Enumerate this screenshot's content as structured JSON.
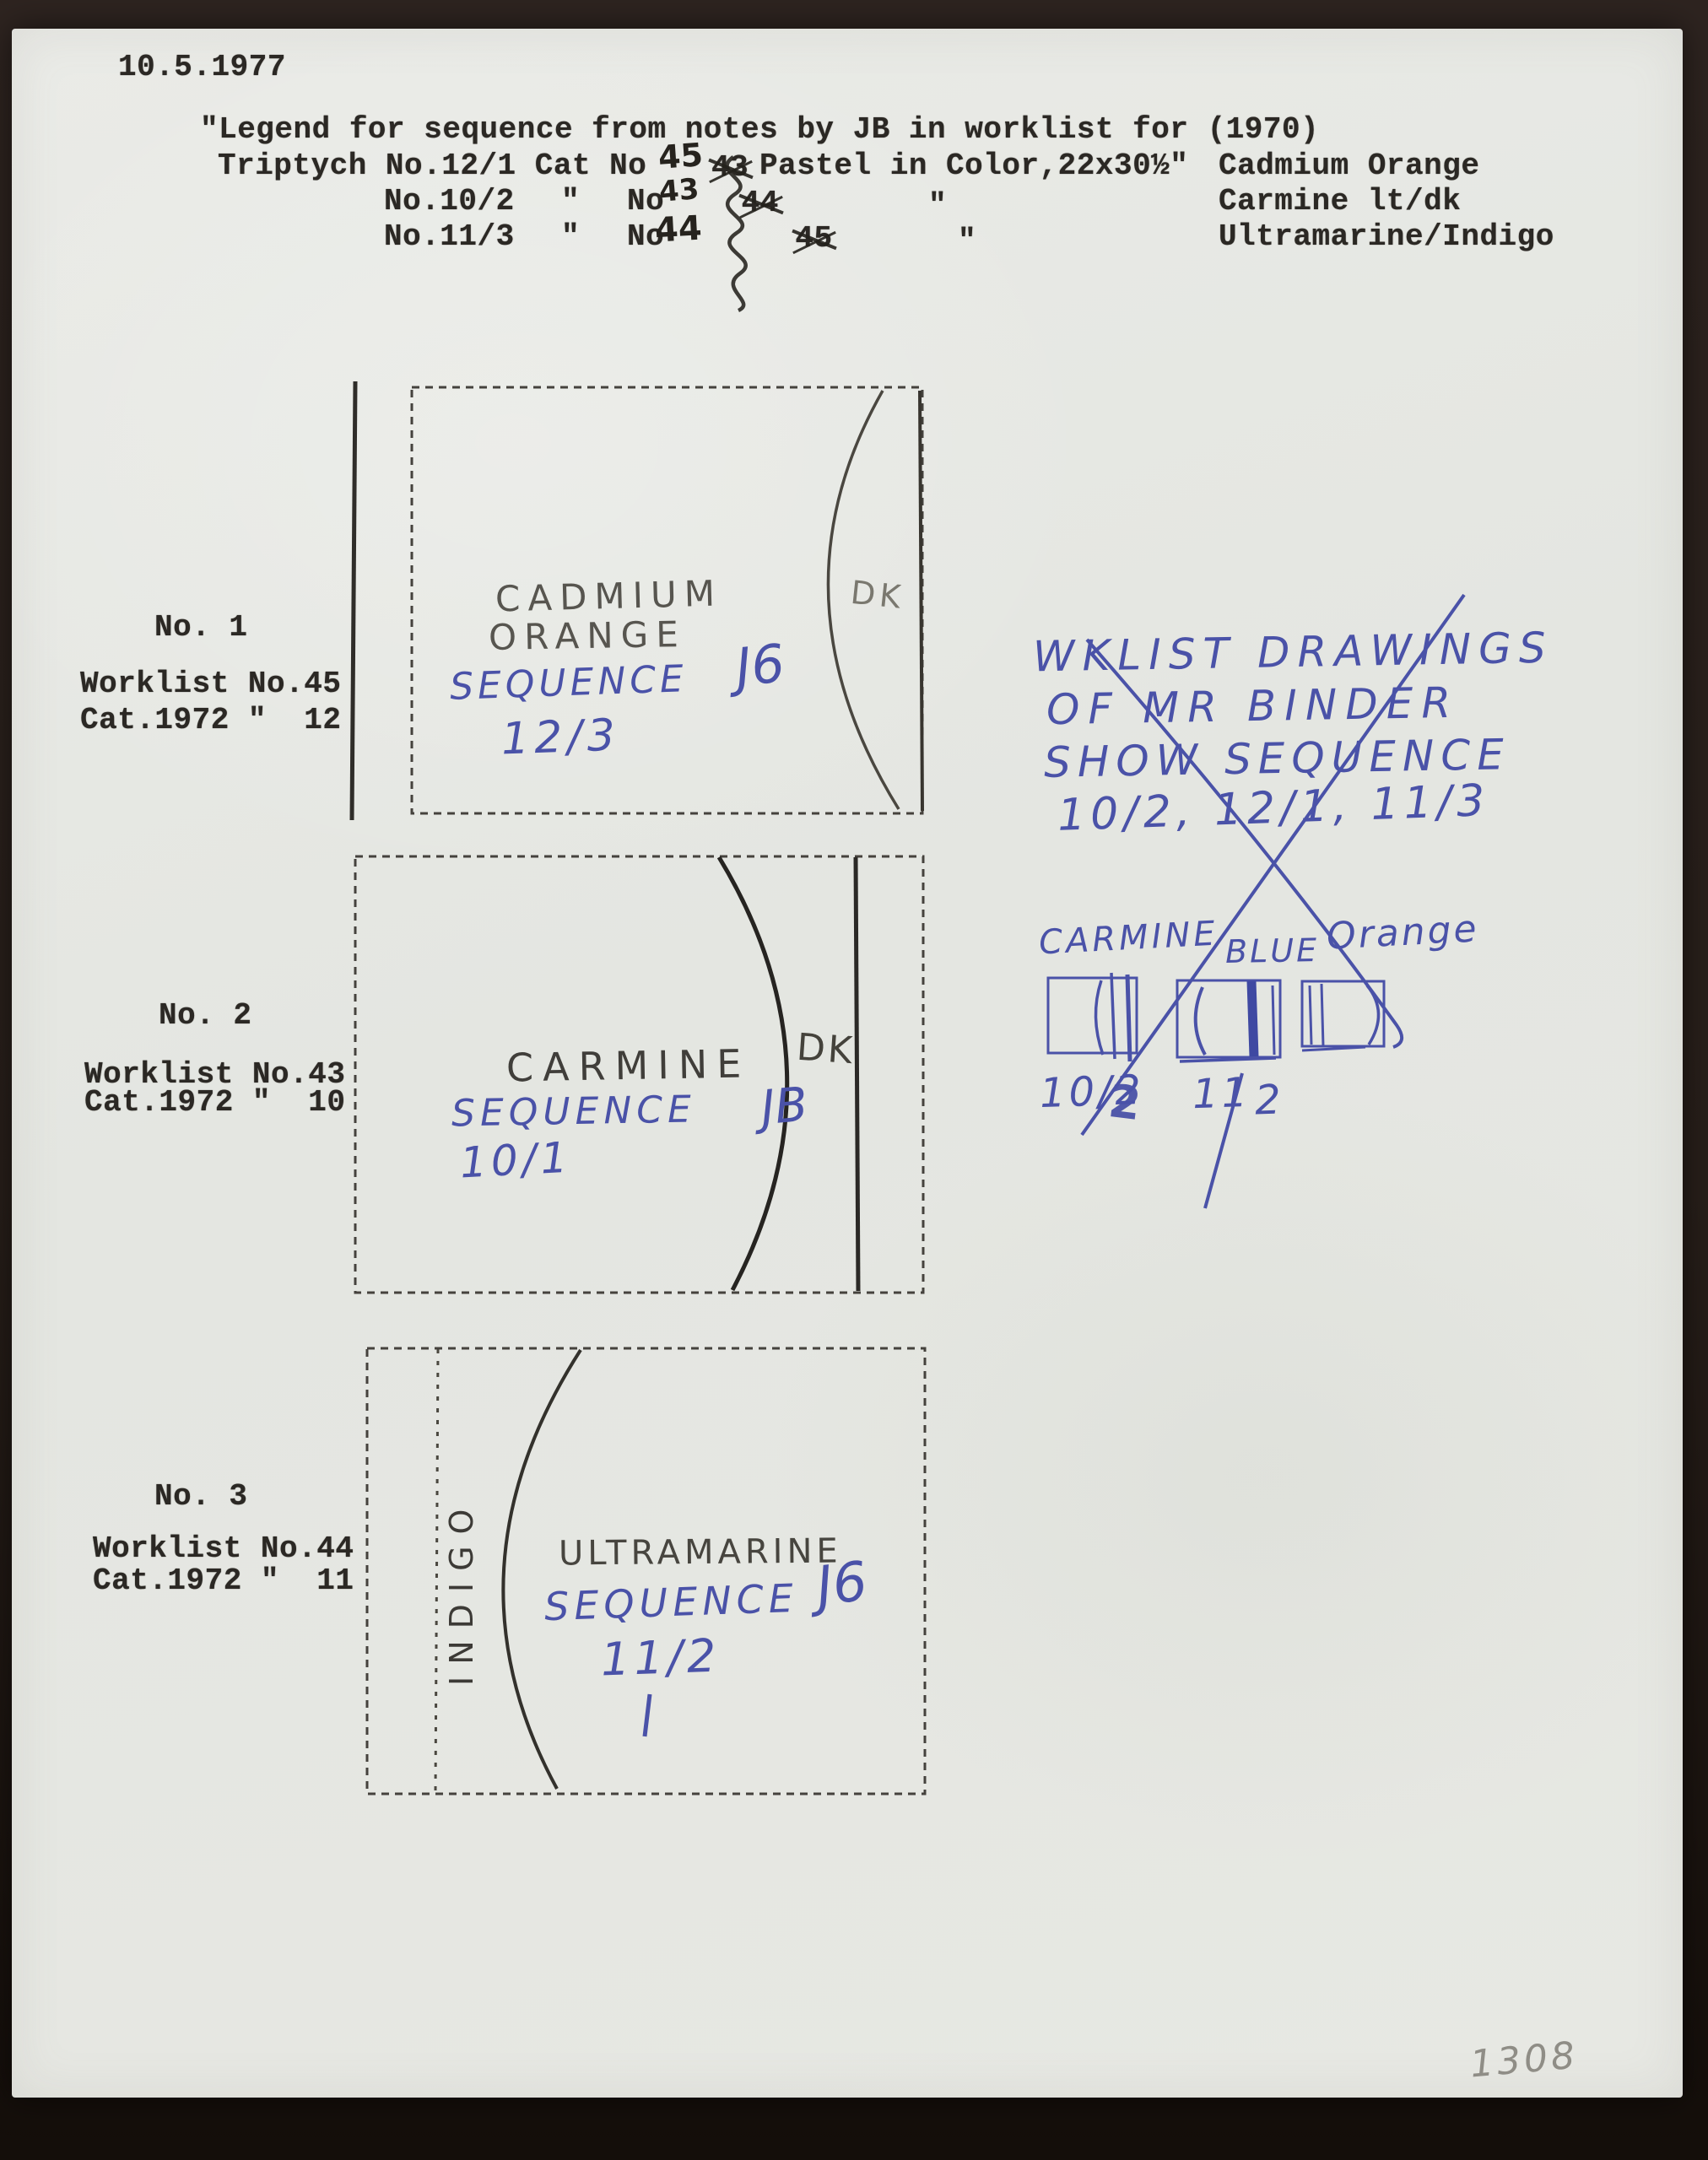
{
  "date": "10.5.1977",
  "page_number": "1308",
  "header": {
    "line1": "\"Legend for sequence from notes by JB in worklist for (1970)",
    "rows": [
      {
        "left": "Triptych No.12/1 Cat No",
        "corrected": "45",
        "struck": "43",
        "middle": "Pastel in Color,22x30½\"",
        "color": "Cadmium Orange"
      },
      {
        "left": "No.10/2",
        "ditto1": "\"",
        "no": "No",
        "corrected": "43",
        "struck": "44",
        "ditto2": "\"",
        "color": "Carmine lt/dk"
      },
      {
        "left": "No.11/3",
        "ditto1": "\"",
        "no": "No",
        "corrected": "44",
        "struck": "45",
        "ditto2": "\"",
        "color": "Ultramarine/Indigo"
      }
    ]
  },
  "panels": [
    {
      "number": "No. 1",
      "worklist": "Worklist No.45",
      "cat": "Cat.1972 \"  12",
      "title_line1": "CADMIUM",
      "title_line2": "ORANGE",
      "sequence_word": "SEQUENCE",
      "sequence_mark": "J6",
      "sequence_number": "12/3",
      "corner_note": "DK"
    },
    {
      "number": "No. 2",
      "worklist": "Worklist No.43",
      "cat": "Cat.1972 \"  10",
      "title_line1": "CARMINE",
      "sequence_word": "SEQUENCE",
      "sequence_mark": "JB",
      "sequence_number": "10/1",
      "corner_note": "DK"
    },
    {
      "number": "No. 3",
      "worklist": "Worklist No.44",
      "cat": "Cat.1972 \"  11",
      "title_line1": "ULTRAMARINE",
      "vertical_label": "INDIGO",
      "sequence_word": "SEQUENCE",
      "sequence_mark": "J6",
      "sequence_number": "11/2"
    }
  ],
  "margin_note": {
    "line1": "WKLIST DRAWINGS",
    "line2": "OF MR BINDER",
    "line3": "SHOW SEQUENCE",
    "line4": "10/2, 12/1, 11/3"
  },
  "thumbnails": {
    "title_word1": "CARMINE",
    "title_word2": "BLUE",
    "title_word3": "Orange",
    "label1": "10/2",
    "label1_overdraw": "2",
    "label2_left": "11",
    "label2_right": "2"
  },
  "colors": {
    "ink_blue": "#4a52a8",
    "pencil_gray": "#55534d",
    "typed_black": "#2b2824",
    "paper": "#e7e8e3",
    "mat_brown": "#271e19"
  }
}
